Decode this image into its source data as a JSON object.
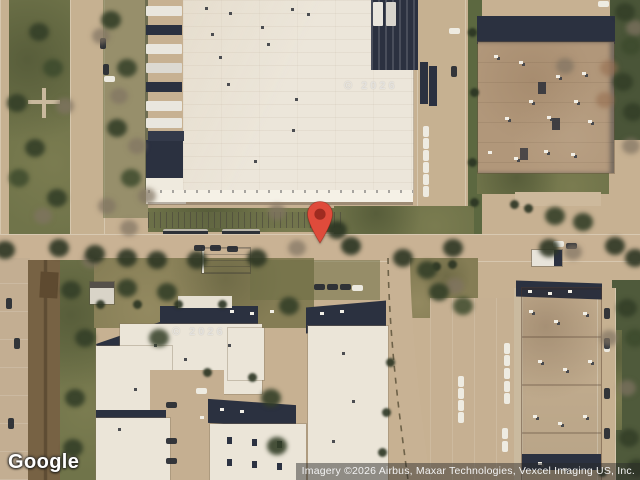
{
  "branding": {
    "logo_text": "Google"
  },
  "attribution": {
    "text": "Imagery ©2026 Airbus, Maxar Technologies, Vexcel Imaging US, Inc."
  },
  "map": {
    "marker": {
      "name": "location-pin",
      "color": "#DF4B3B",
      "dot_color": "#9E2B20"
    },
    "watermark": "© 2026",
    "palette": {
      "pavement": "#C7B192",
      "warehouse_roof": "#ECE6DA",
      "grass": "#70744A",
      "shadow_navy": "#2B3140",
      "brick_roof_ne": "#B1977A",
      "brick_roof_se": "#9A7052"
    }
  }
}
